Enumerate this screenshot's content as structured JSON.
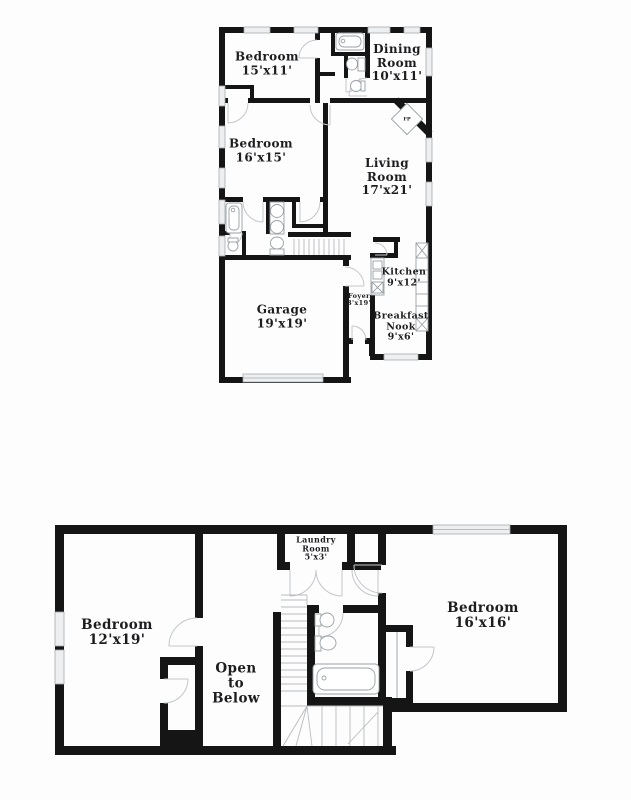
{
  "document": {
    "type": "floor-plan",
    "floor_count": 2
  },
  "colors": {
    "wall": "#151515",
    "label_text": "#1d1d20",
    "window_fill": "#edeff1",
    "window_stroke": "#a6abb0",
    "door_stroke": "#c3c6c9",
    "fixture_stroke": "#9aa0a6",
    "stair_stroke": "#b7babd",
    "background": "#fdfdfe"
  },
  "floor1": {
    "rooms": {
      "bedroom_a": {
        "lines": [
          "Bedroom",
          "15'x11'"
        ]
      },
      "dining": {
        "lines": [
          "Dining",
          "Room",
          "10'x11'"
        ]
      },
      "bedroom_b": {
        "lines": [
          "Bedroom",
          "16'x15'"
        ]
      },
      "living": {
        "lines": [
          "Living",
          "Room",
          "17'x21'"
        ]
      },
      "kitchen": {
        "lines": [
          "Kitchen",
          "9'x12'"
        ]
      },
      "foyer": {
        "lines": [
          "Foyer",
          "3'x19'"
        ]
      },
      "breakfast": {
        "lines": [
          "Breakfast",
          "Nook",
          "9'x6'"
        ]
      },
      "garage": {
        "lines": [
          "Garage",
          "19'x19'"
        ]
      },
      "fireplace": {
        "lines": [
          "FP"
        ]
      }
    }
  },
  "floor2": {
    "rooms": {
      "laundry": {
        "lines": [
          "Laundry",
          "Room",
          "5'x3'"
        ]
      },
      "bedroom_c": {
        "lines": [
          "Bedroom",
          "12'x19'"
        ]
      },
      "open_below": {
        "lines": [
          "Open",
          "to",
          "Below"
        ]
      },
      "bedroom_d": {
        "lines": [
          "Bedroom",
          "16'x16'"
        ]
      }
    }
  }
}
